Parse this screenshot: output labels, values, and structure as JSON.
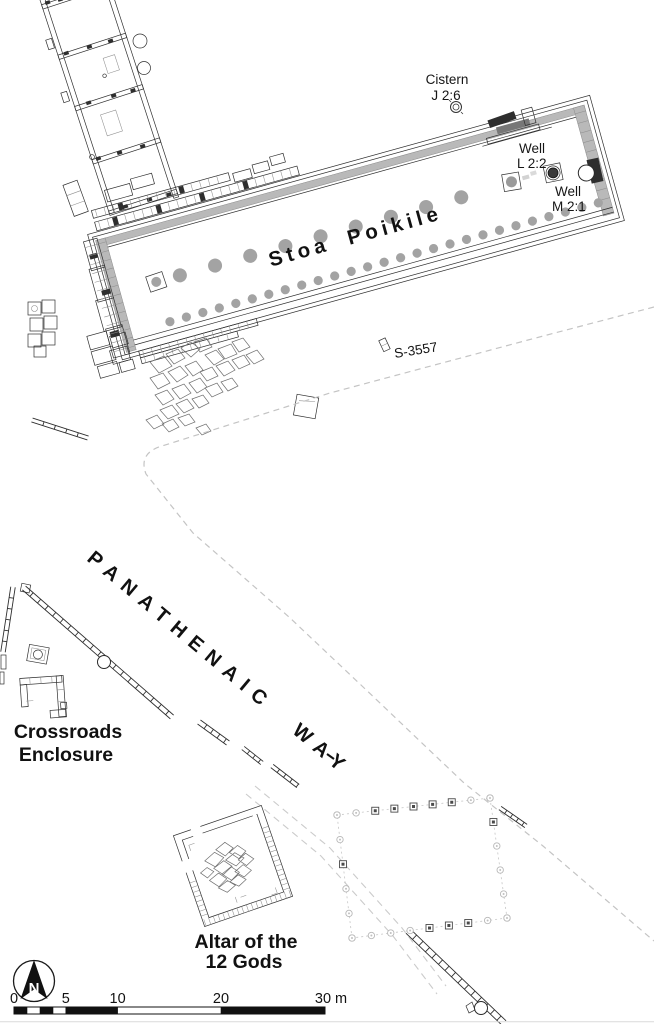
{
  "labels": {
    "stoa": "Stoa Poikile",
    "cistern_1": "Cistern",
    "cistern_2": "J 2:6",
    "well_l_1": "Well",
    "well_l_2": "L 2:2",
    "well_m_1": "Well",
    "well_m_2": "M 2:1",
    "find": "S-3557",
    "way": "PANATHENAIC WAY",
    "crossroads_1": "Crossroads",
    "crossroads_2": "Enclosure",
    "altar_1": "Altar of the",
    "altar_2": "12 Gods",
    "north": "N"
  },
  "scale_bar": {
    "tick_0": "0",
    "tick_5": "5",
    "tick_10": "10",
    "tick_20": "20",
    "tick_30": "30 m",
    "total_meters": 30
  },
  "colors": {
    "background": "#ffffff",
    "ink": "#1a1a1a",
    "wall_gray": "#b9b9b9",
    "column_dot": "#a3a3a3",
    "dashed_road": "#c4c4c4"
  }
}
